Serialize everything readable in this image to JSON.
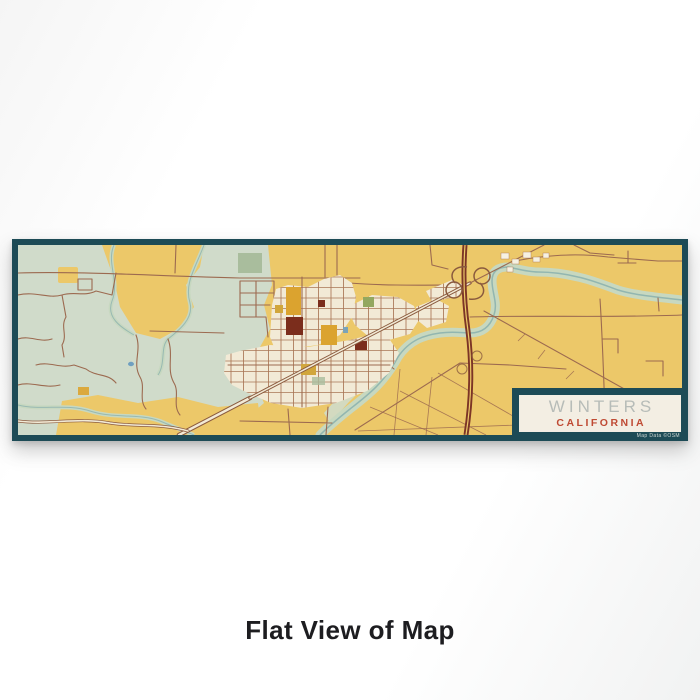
{
  "page": {
    "caption": "Flat View of Map"
  },
  "print": {
    "title": "WINTERS",
    "subtitle": "CALIFORNIA",
    "attribution": "Map Data ©OSM",
    "colors": {
      "frame_teal": "#1d4b56",
      "land_yellow": "#ecc869",
      "terrain_sage": "#d0dbca",
      "terrain_sage_dark": "#a9bd9d",
      "town_cream": "#f2ead6",
      "street_brown": "#a5704e",
      "road_brown": "#9c6a50",
      "highway_dark": "#7c3526",
      "main_road_casing": "#8a5a3e",
      "creek_band": "#c7d8c0",
      "creek_water": "#92b6b0",
      "block_maroon": "#7b2d1c",
      "block_amber": "#dba32f",
      "block_mustard": "#d1a63c",
      "block_olive": "#93a75f",
      "pond_blue": "#6f9fc0",
      "building_white": "#f6f1e2",
      "label_bg": "#f3eee3",
      "title_gray": "#b7bcb8",
      "subtitle_rust": "#bf4a33",
      "caption_black": "#1d1d20",
      "attribution_text": "#cfd8d4"
    }
  }
}
